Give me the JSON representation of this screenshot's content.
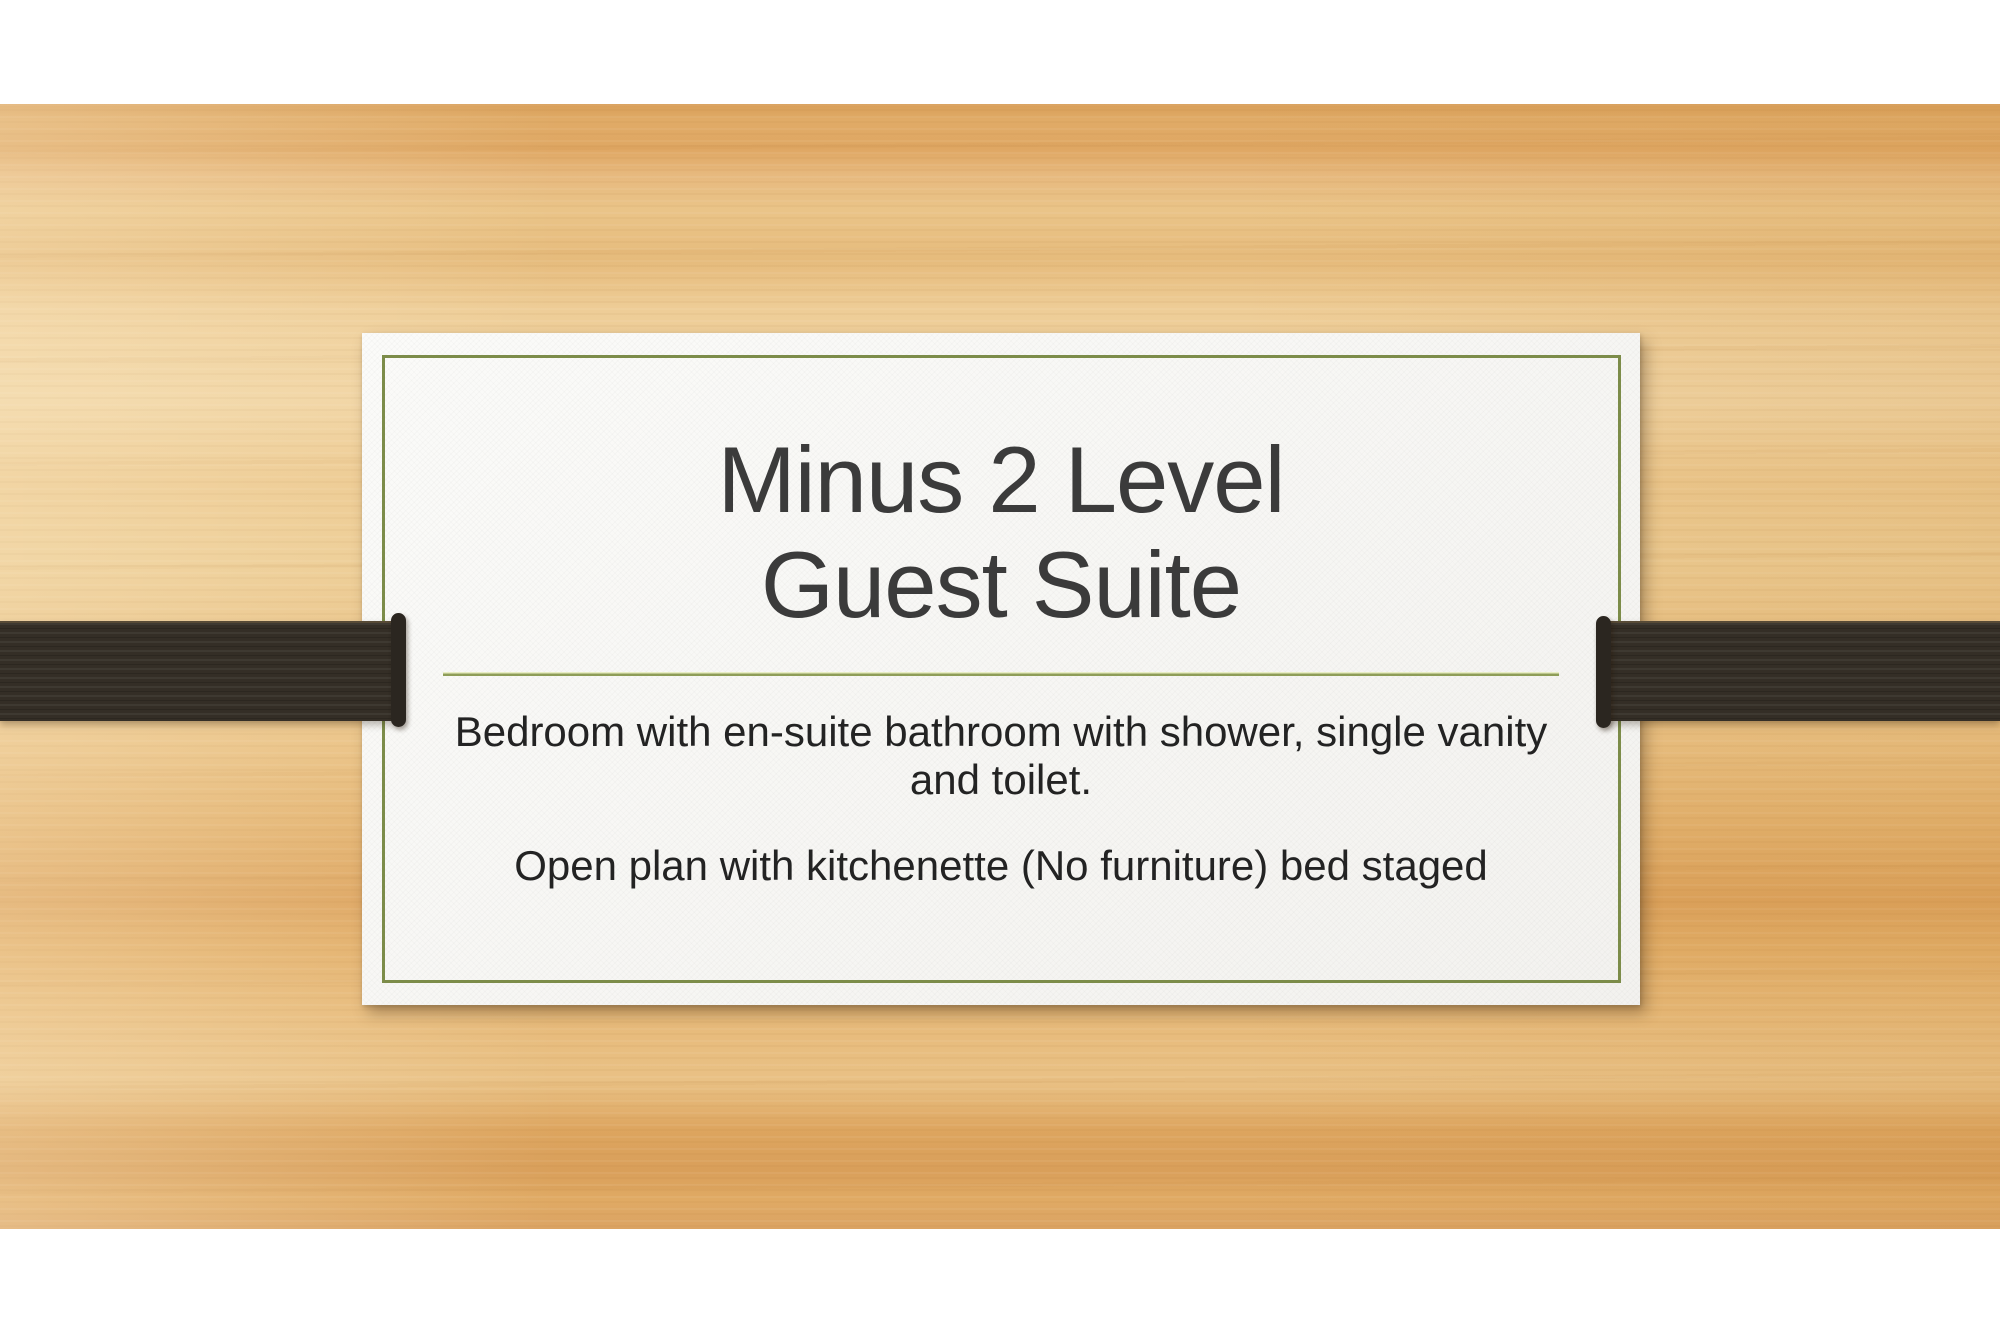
{
  "slide": {
    "title": {
      "lines": [
        "Minus 2 Level",
        "Guest Suite"
      ]
    },
    "body": {
      "paragraphs": [
        "Bedroom with en-suite bathroom with shower, single vanity and toilet.",
        "Open plan with kitchenette (No furniture) bed staged"
      ]
    },
    "colors": {
      "title_text": "#3b3b3b",
      "body_text": "#232323",
      "border_green": "#7c8c49",
      "separator_green": "#8e9d58",
      "ribbon_brown": "#342e26",
      "card_bg": "#fbfbf9",
      "wood_light": "#eecd97",
      "wood_dark": "#d89e58"
    }
  }
}
